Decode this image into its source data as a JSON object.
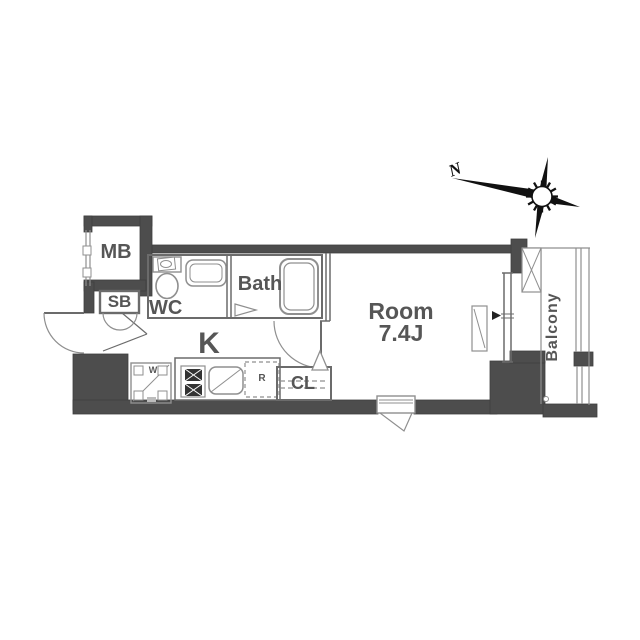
{
  "plan": {
    "labels": {
      "mb": "MB",
      "sb": "SB",
      "wc": "WC",
      "bath": "Bath",
      "kitchen": "K",
      "room_name": "Room",
      "room_size": "7.4J",
      "closet": "CL",
      "balcony": "Balcony",
      "washer": "W",
      "refrigerator": "R"
    },
    "compass": {
      "north": "N"
    },
    "colors": {
      "wall": "#4d4d4d",
      "partition": "#6b6b6b",
      "fixture": "#8f8f8f",
      "text": "#565656",
      "burner": "#333333",
      "compass": "#111111"
    }
  }
}
